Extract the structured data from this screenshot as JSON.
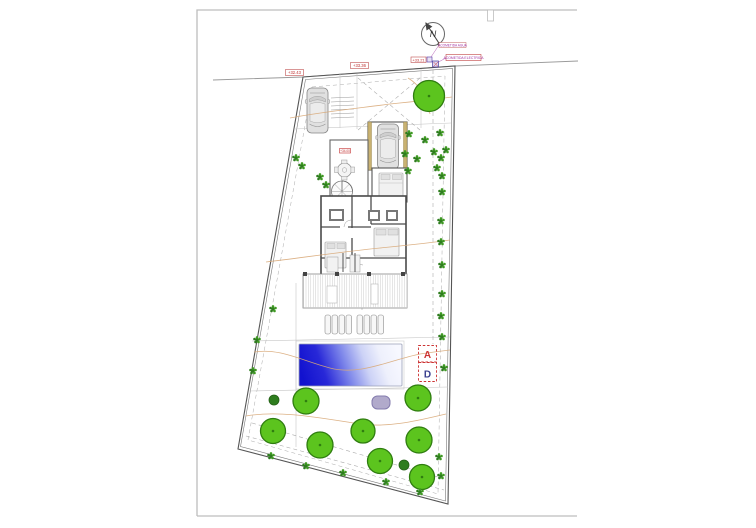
{
  "drawing": {
    "compass_label": "N",
    "elevation_labels": [
      {
        "id": "street1",
        "text": "+32.43"
      },
      {
        "id": "street2",
        "text": "+33.36"
      },
      {
        "id": "corner",
        "text": "+33.21"
      },
      {
        "id": "house",
        "text": "+34.00"
      }
    ],
    "utility_labels": {
      "water": "ACOMETIDA AGUA",
      "electric": "ACOMETIDA ELECTRICA"
    },
    "section_markers": {
      "a": "A",
      "d": "D"
    },
    "colors": {
      "tree_fill": "#5cc41e",
      "tree_stroke": "#2f7d10",
      "bush": "#3f9a22",
      "bush_dark": "#2e7d1e",
      "pool_deep": "#1212cf",
      "pool_mid": "#7d86ea",
      "pool_shallow": "#f7f8ff",
      "wall": "#4a4a4a",
      "tan": "#c9b272",
      "contour": "#d8a878",
      "label_red": "#c03030",
      "label_magenta": "#a030a0",
      "section_a_color": "#cc3333",
      "section_d_color": "#3a3f8f",
      "spa_fill": "#b1aacb",
      "spa_stroke": "#847cae",
      "dash": "#ababab",
      "thin": "#c6c6c6"
    },
    "trees": [
      {
        "x": 429,
        "y": 96,
        "r": 15.5
      },
      {
        "x": 306,
        "y": 401,
        "r": 13
      },
      {
        "x": 418,
        "y": 398,
        "r": 13
      },
      {
        "x": 273,
        "y": 431,
        "r": 12.5
      },
      {
        "x": 320,
        "y": 445,
        "r": 13
      },
      {
        "x": 363,
        "y": 431,
        "r": 12
      },
      {
        "x": 380,
        "y": 461,
        "r": 12.5
      },
      {
        "x": 419,
        "y": 440,
        "r": 13
      },
      {
        "x": 422,
        "y": 477,
        "r": 12.5
      }
    ],
    "small_trees": [
      {
        "x": 274,
        "y": 400,
        "r": 5
      },
      {
        "x": 404,
        "y": 465,
        "r": 5
      }
    ],
    "bushes": [
      {
        "x": 441,
        "y": 158
      },
      {
        "x": 442,
        "y": 176
      },
      {
        "x": 442,
        "y": 192
      },
      {
        "x": 441,
        "y": 221
      },
      {
        "x": 441,
        "y": 242
      },
      {
        "x": 442,
        "y": 265
      },
      {
        "x": 442,
        "y": 294
      },
      {
        "x": 441,
        "y": 316
      },
      {
        "x": 442,
        "y": 337
      },
      {
        "x": 409,
        "y": 134
      },
      {
        "x": 425,
        "y": 140
      },
      {
        "x": 440,
        "y": 133
      },
      {
        "x": 405,
        "y": 154
      },
      {
        "x": 417,
        "y": 159
      },
      {
        "x": 434,
        "y": 152
      },
      {
        "x": 446,
        "y": 150
      },
      {
        "x": 408,
        "y": 171
      },
      {
        "x": 437,
        "y": 168
      },
      {
        "x": 296,
        "y": 158
      },
      {
        "x": 302,
        "y": 166
      },
      {
        "x": 320,
        "y": 177
      },
      {
        "x": 326,
        "y": 185
      },
      {
        "x": 273,
        "y": 309
      },
      {
        "x": 257,
        "y": 340
      },
      {
        "x": 253,
        "y": 371
      },
      {
        "x": 271,
        "y": 456
      },
      {
        "x": 306,
        "y": 466
      },
      {
        "x": 343,
        "y": 473
      },
      {
        "x": 386,
        "y": 482
      },
      {
        "x": 420,
        "y": 492
      },
      {
        "x": 441,
        "y": 476
      },
      {
        "x": 439,
        "y": 457
      },
      {
        "x": 444,
        "y": 368
      }
    ],
    "loungers": [
      {
        "x": 325,
        "y": 315
      },
      {
        "x": 332,
        "y": 315
      },
      {
        "x": 339,
        "y": 315
      },
      {
        "x": 346,
        "y": 315
      },
      {
        "x": 357,
        "y": 315
      },
      {
        "x": 364,
        "y": 315
      },
      {
        "x": 371,
        "y": 315
      },
      {
        "x": 378,
        "y": 315
      }
    ],
    "contours": [
      "M290,118 C320,112 360,108 390,104 C410,102 430,100 452,97",
      "M266,262 C300,258 340,252 380,248 C410,245 430,243 450,240",
      "M254,352 C280,348 300,360 330,368 C360,376 390,360 420,354 C432,352 442,351 450,350",
      "M246,416 C280,410 320,418 360,424 C390,428 420,420 446,414",
      "M408,78 C420,85 427,98 430,114"
    ],
    "dashed_lines": [
      [
        358,
        78,
        420,
        130
      ],
      [
        420,
        78,
        358,
        130
      ],
      [
        433,
        70,
        433,
        344
      ],
      [
        362,
        196,
        362,
        310
      ],
      [
        246,
        436,
        444,
        490
      ],
      [
        252,
        423,
        438,
        477
      ]
    ],
    "thin_lines": [
      [
        294,
        129,
        451,
        123
      ],
      [
        252,
        341,
        450,
        337
      ],
      [
        249,
        391,
        448,
        387
      ],
      [
        296,
        283,
        296,
        447
      ],
      [
        340,
        73,
        340,
        128
      ],
      [
        357,
        74,
        357,
        129
      ],
      [
        421,
        69,
        421,
        128
      ]
    ]
  }
}
